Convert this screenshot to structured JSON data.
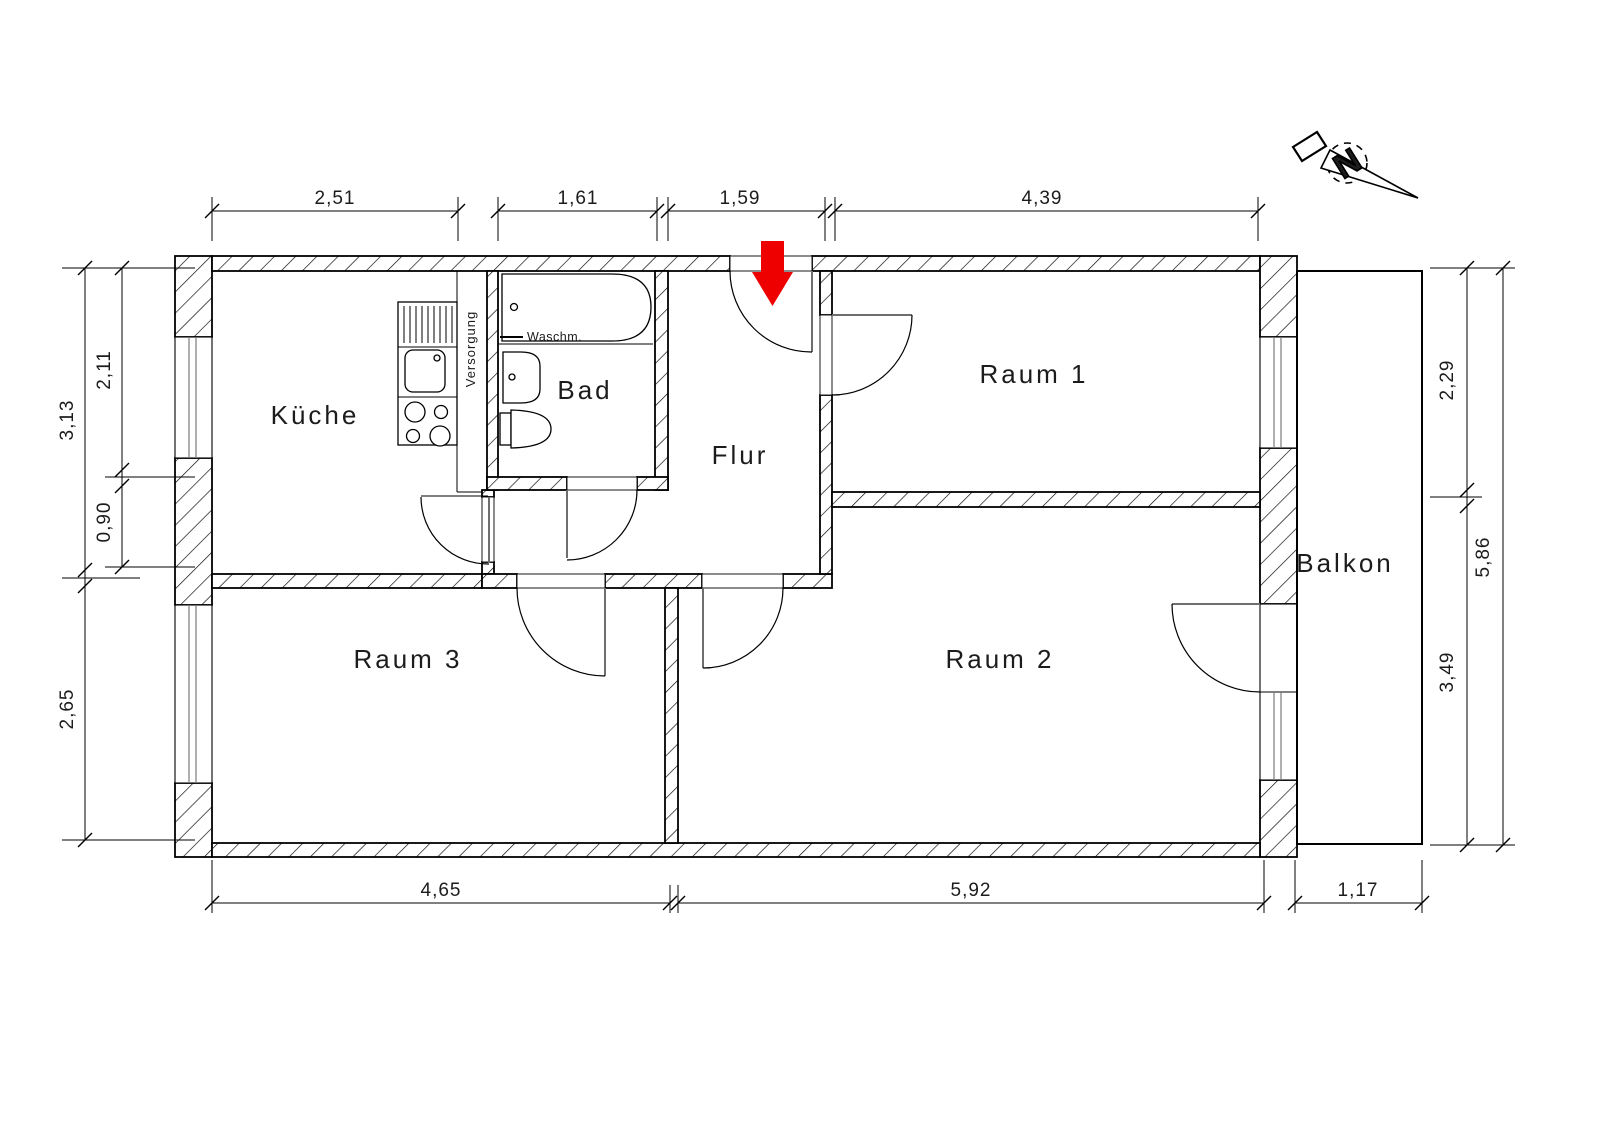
{
  "rooms": [
    {
      "id": "kueche",
      "label": "Küche"
    },
    {
      "id": "bad",
      "label": "Bad"
    },
    {
      "id": "flur",
      "label": "Flur"
    },
    {
      "id": "raum1",
      "label": "Raum 1"
    },
    {
      "id": "raum2",
      "label": "Raum 2"
    },
    {
      "id": "raum3",
      "label": "Raum 3"
    },
    {
      "id": "balkon",
      "label": "Balkon"
    }
  ],
  "annotations": {
    "washing_machine": "Waschm.",
    "supply_shaft": "Versorgung",
    "north_letter": "N"
  },
  "dimensions_m": {
    "top": [
      "2,51",
      "1,61",
      "1,59",
      "4,39"
    ],
    "bottom": [
      "4,65",
      "5,92",
      "1,17"
    ],
    "left_outer": [
      "3,13",
      "2,65"
    ],
    "left_inner": [
      "2,11",
      "0,90"
    ],
    "right_inner": [
      "2,29",
      "3,49"
    ],
    "right_outer": [
      "5,86"
    ]
  },
  "colors": {
    "line": "#000000",
    "text": "#1c1c1c",
    "entrance_arrow": "#ee0000",
    "door_leaf": "#6e6e6e",
    "background": "#ffffff"
  }
}
